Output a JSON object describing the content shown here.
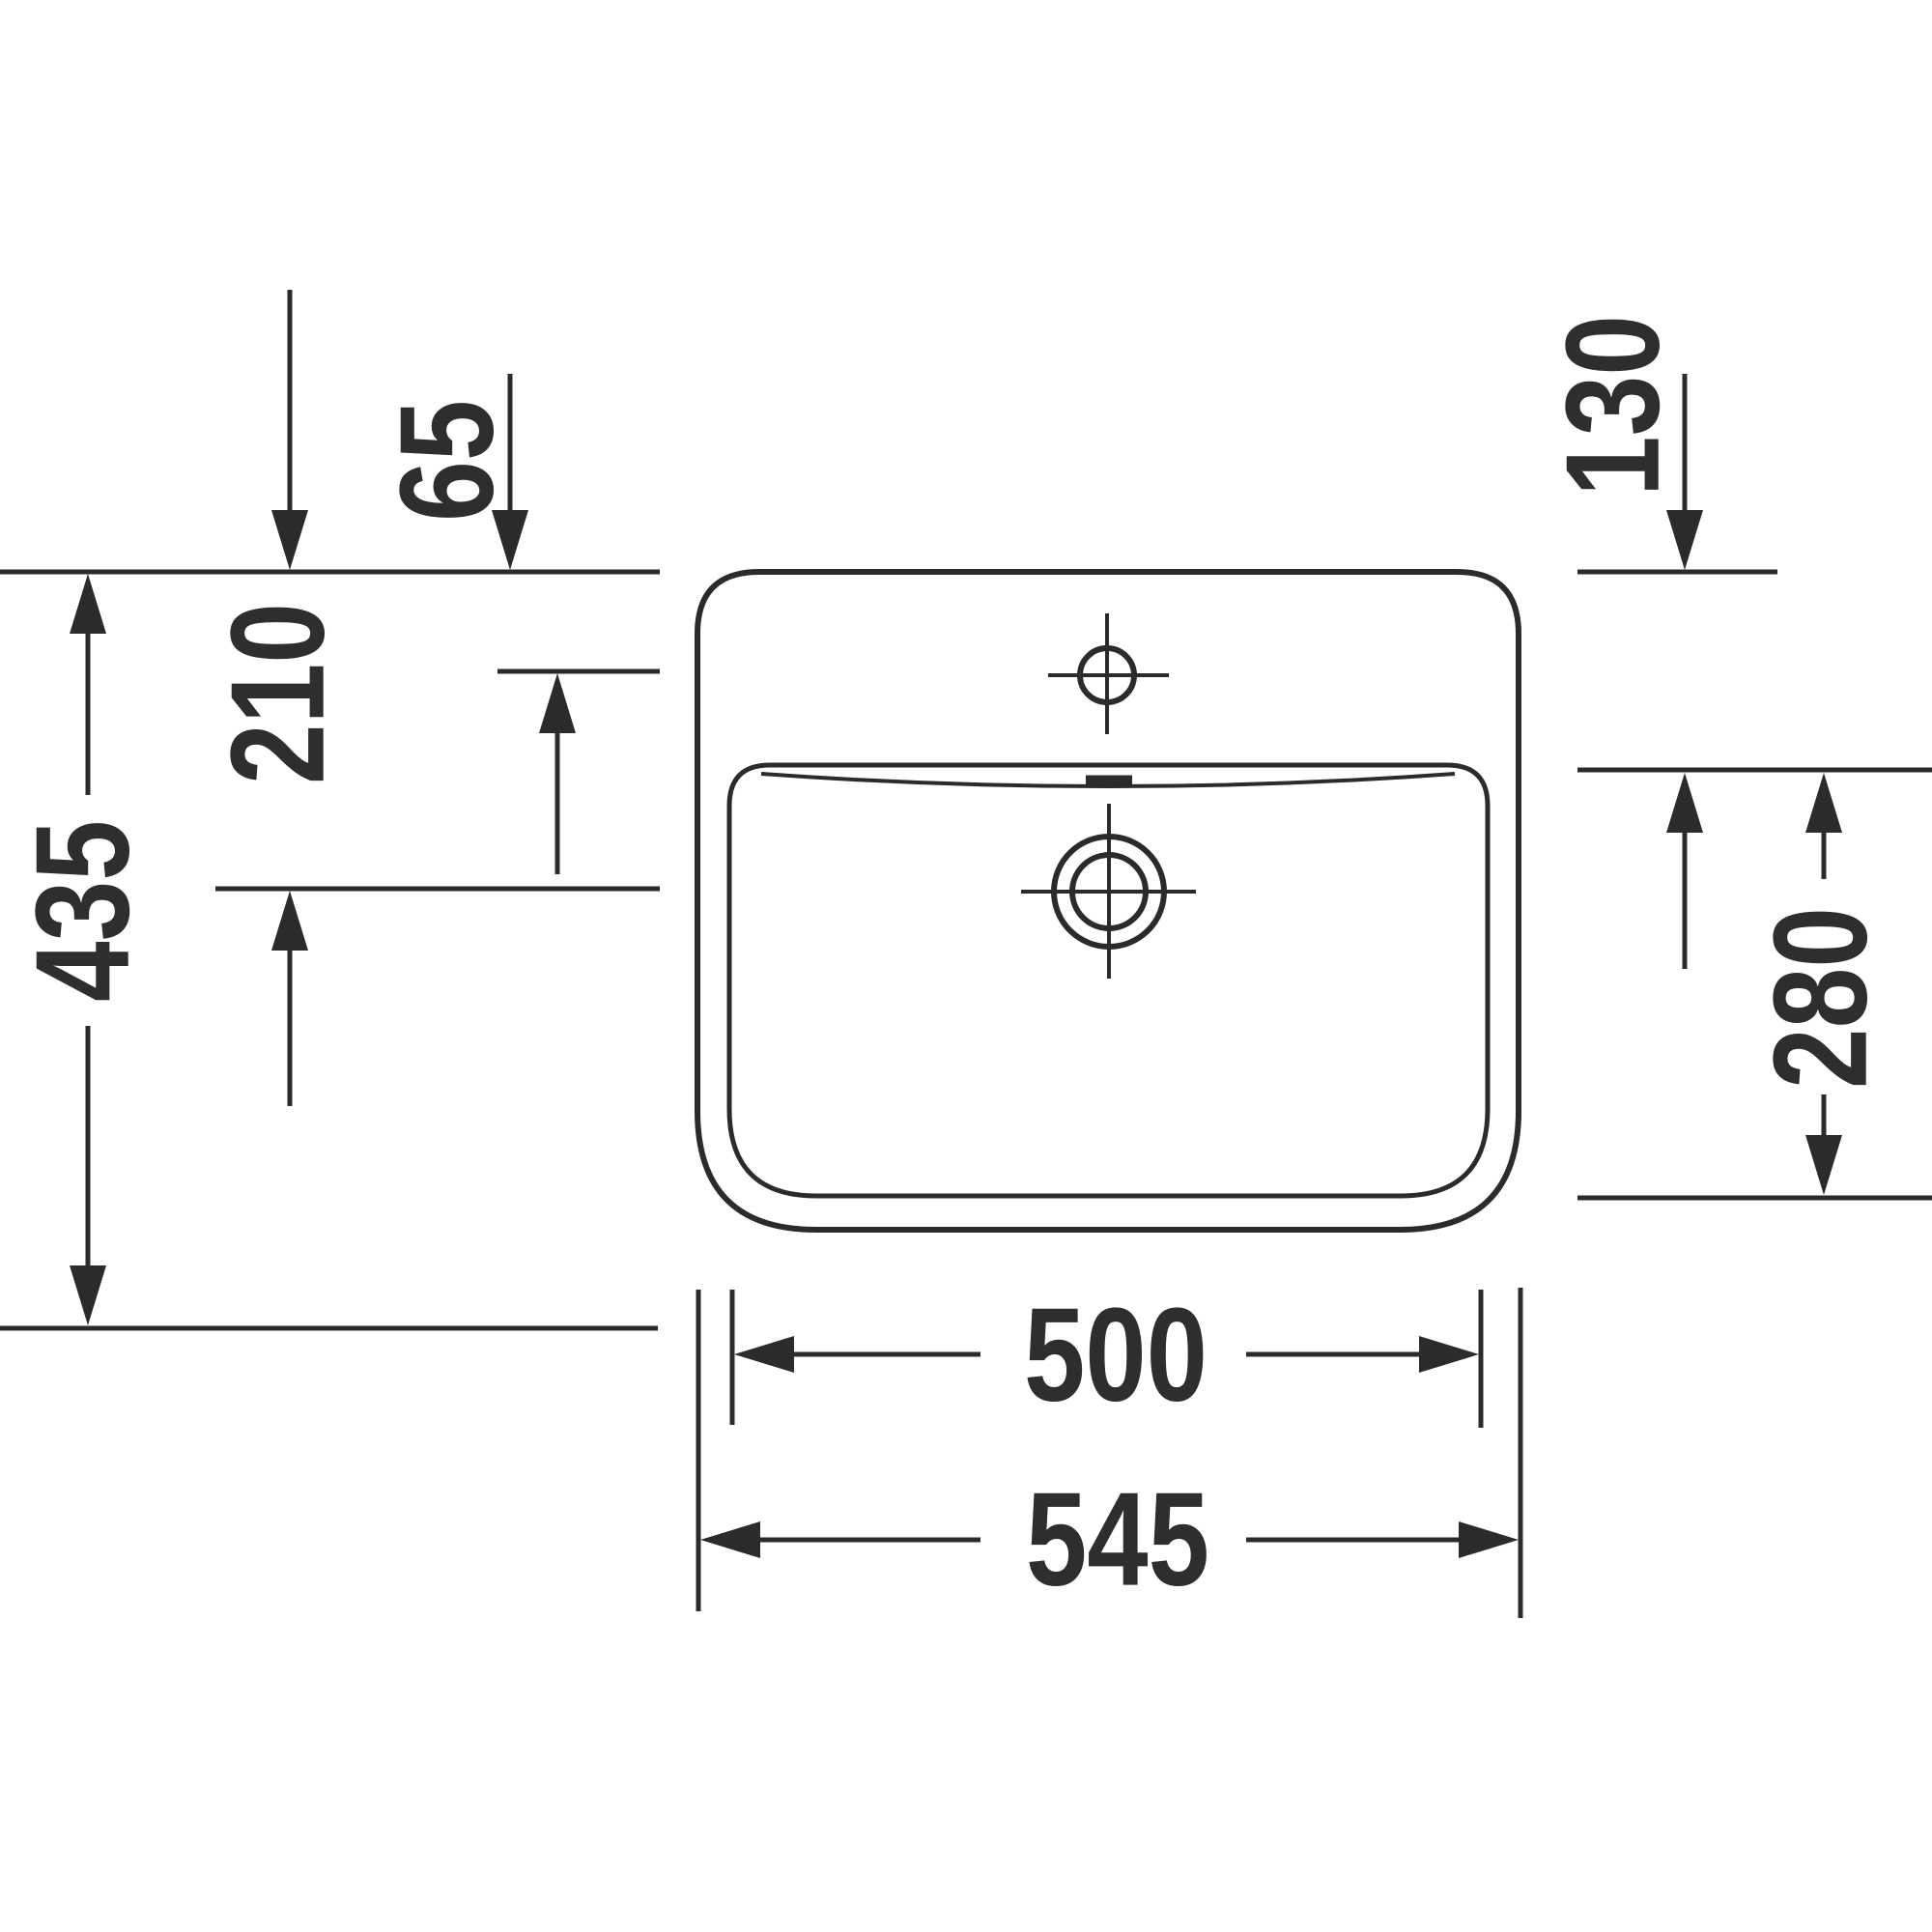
{
  "drawing": {
    "kind": "sanitary-ware plan-view technical drawing",
    "subject": "rectangular washbasin with single faucet hole and drain, annotated with millimetre dimensions",
    "background_color": "#ffffff",
    "line_color": "#2b2b2e",
    "text_color": "#2e2e31",
    "dimensions": {
      "faucet_hole_offset": {
        "value": "65",
        "orientation": "vertical"
      },
      "tap_back_offset": {
        "value": "130",
        "orientation": "vertical"
      },
      "drain_offset": {
        "value": "210",
        "orientation": "vertical"
      },
      "bowl_depth": {
        "value": "280",
        "orientation": "vertical"
      },
      "overall_depth": {
        "value": "435",
        "orientation": "vertical"
      },
      "bowl_width": {
        "value": "500",
        "orientation": "horizontal"
      },
      "overall_width": {
        "value": "545",
        "orientation": "horizontal"
      }
    }
  }
}
